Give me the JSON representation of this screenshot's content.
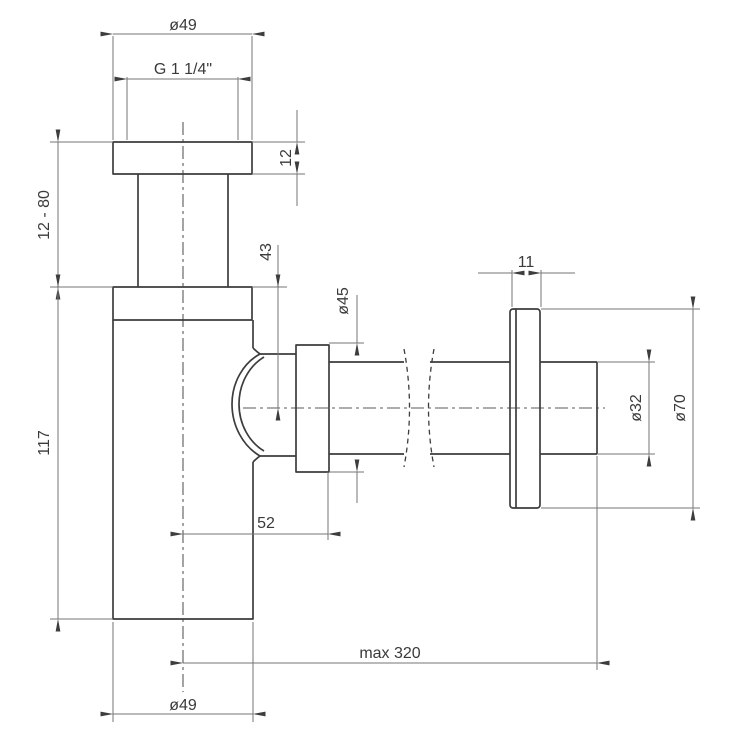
{
  "labels": {
    "top_diameter": "ø49",
    "thread_size": "G 1 1/4\"",
    "top_flange_height": "12",
    "adjustment_range": "12 - 80",
    "body_height": "117",
    "outlet_center_offset": "43",
    "nut_diameter": "ø45",
    "wall_flange_width": "11",
    "outlet_pipe_diameter": "ø32",
    "wall_flange_diameter": "ø70",
    "outlet_horizontal_offset": "52",
    "max_length": "max 320",
    "bottom_diameter": "ø49"
  },
  "colors": {
    "outline": "#3d3d3d",
    "dimension_line": "#757575",
    "centerline": "#5a5a5a",
    "text": "#3a3a3a",
    "background": "#ffffff"
  }
}
